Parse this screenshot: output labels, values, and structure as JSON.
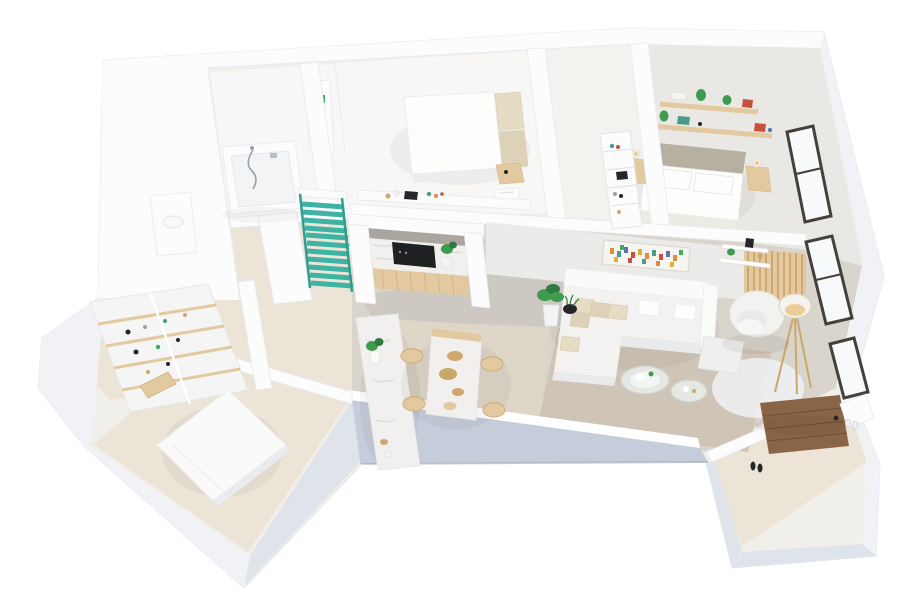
{
  "meta": {
    "title": "3D isometric apartment floor plan - white architectural render",
    "canvas_width": 900,
    "canvas_height": 600,
    "visible_text": []
  },
  "colors": {
    "bg": "#ffffff",
    "base": "#f1efe9",
    "wallWhite": "#fcfcfd",
    "wallTop": "#ffffff",
    "wallEdge": "#e4e7ec",
    "faceWall": "#ebebe9",
    "faceLight": "#f0f2f5",
    "faceMid": "#dfe3ea",
    "faceBlue": "#c6cdda",
    "faceBlueDark": "#9aa2b2",
    "floorWhite": "#f8f7f5",
    "floorIvory": "#f4f2ee",
    "floorBeige": "#ece4d6",
    "floorSand": "#ded6c7",
    "floorGrey": "#cdc9c2",
    "floorGreyWarm": "#d9d4cc",
    "carpet": "#eae8e4",
    "rug": "#cfc5b6",
    "rugWhite": "#eff1f3",
    "marble": "#f1f0ee",
    "marbleVein": "#d8d7d3",
    "nicheGrey": "#aaa69f",
    "woodLight": "#e3c99f",
    "woodMid": "#cfa86f",
    "woodSeam": "#d2b383",
    "doorWood": "#8a6446",
    "doorWoodDark": "#6f4e33",
    "teal": "#3db3a4",
    "tealDark": "#2f9d8f",
    "plant": "#3e9b4f",
    "plantDark": "#2f7a40",
    "dark": "#26262a",
    "cooktop": "#1f2022",
    "cream": "#e6dcc3",
    "creamDark": "#ddd2b8",
    "pillowWhite": "#fdfdfc",
    "lampWarm": "#e9c98e",
    "brass": "#c9a86a",
    "frameDark": "#46403a",
    "glass": "#f8f9fa",
    "grey": "#9aa0ab",
    "accentRed": "#c8503e",
    "accentOrange": "#e08a3c",
    "accentTeal": "#4a9a8e",
    "accentBlue": "#5b79a8",
    "accentYellow": "#d9b13b",
    "accentGreen": "#3fae62"
  },
  "scene": {
    "type": "isometric-3d-floorplan",
    "style": "white model render, view from above south-east",
    "rooms": [
      {
        "id": "bathroom",
        "furniture": [
          "bathtub",
          "shower-hose",
          "vanity-unit",
          "tall-cabinet-with-green-sticker"
        ]
      },
      {
        "id": "master-bedroom",
        "furniture": [
          "double-bed",
          "cream-pillows",
          "nightstand",
          "magazine-basket",
          "desk-counter",
          "desk-accessories"
        ]
      },
      {
        "id": "wardrobe-hallway",
        "furniture": [
          "open-shelf-unit",
          "shoes",
          "books"
        ]
      },
      {
        "id": "bedroom-2",
        "furniture": [
          "double-bed",
          "upholstered-headboard",
          "nightstands",
          "table-lamps",
          "floating-wood-shelves",
          "plants",
          "books",
          "window"
        ]
      },
      {
        "id": "kitchen",
        "furniture": [
          "marble-backsplash",
          "black-cooktop-unit",
          "wood-base-cabinets",
          "island-counter",
          "potted-plant"
        ]
      },
      {
        "id": "dining-area",
        "furniture": [
          "marble-dining-table",
          "wood-chairs",
          "decor-bowls"
        ]
      },
      {
        "id": "living-room",
        "furniture": [
          "sectional-sofa",
          "throw-pillows",
          "round-coffee-tables",
          "armchair",
          "ottoman",
          "tripod-floor-lamp",
          "area-rug",
          "white-fluffy-rug",
          "abstract-wall-art",
          "wall-shelf",
          "corner-plants",
          "wood-slat-partition",
          "windows"
        ]
      },
      {
        "id": "walk-in-closet",
        "furniture": [
          "corner-shelving-unit",
          "shoes",
          "boxes"
        ]
      },
      {
        "id": "storage-bedroom",
        "furniture": [
          "mattress",
          "wood-bench"
        ]
      },
      {
        "id": "entry-hall",
        "furniture": [
          "wood-front-door",
          "shoe-bench",
          "shoes"
        ]
      },
      {
        "id": "staircase",
        "furniture": [
          "teal-stairs",
          "teal-railings"
        ]
      }
    ]
  }
}
